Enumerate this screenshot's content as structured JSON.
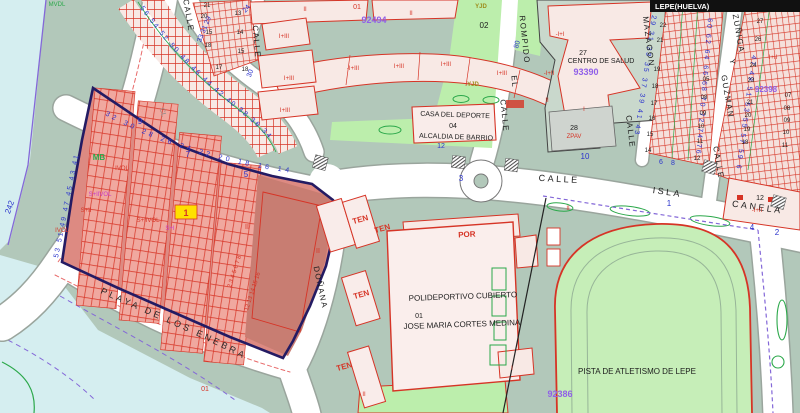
{
  "title": "LEPE(HUELVA)",
  "colors": {
    "c-sage": "#b2c8ba",
    "c-park": "#bceeac",
    "c-cyan": "#d5eef0",
    "c-street": "#ffffff",
    "c-casing": "#9aa59d",
    "c-pink": "#f8e9e5",
    "c-red": "#d63426",
    "c-blue": "#2a33cc",
    "c-purple": "#9060e8",
    "c-magenta": "#c83cc8",
    "c-greenline": "#2ba84a",
    "c-olive": "#9c8c1a",
    "c-zonebase": "#dd8a82",
    "c-zonestrip": "#f0a89f",
    "c-zonedark": "#c87d72",
    "c-zoneborder": "#241b63",
    "c-boundary": "#8468d8",
    "c-yellow": "#ffe000",
    "c-titlebar": "#111111"
  },
  "curved": {
    "chain_a": "56 54 52 50 48 46 44 42 40 38 36 34",
    "chain_b": "32 30 28 26 24 22 20 18 16 14",
    "left_edge": "53 51 49 47 45 43 41",
    "mazagon_w": "29 31 33 35 37 39 41 43",
    "guzman_w": "60 62 64 66 68 70 72 74 76",
    "guzman_e": "47 49 51 53 55 57 59 61",
    "playa": "PLAYA  DE  LOS  ENEBRALES"
  },
  "map": {
    "labels": [
      {
        "t": "MVDL",
        "x": 57,
        "y": 6,
        "r": 0,
        "c": "s6 c-green"
      },
      {
        "t": "CALLE",
        "x": 186,
        "y": 16,
        "r": 80,
        "c": "s8 c-black ls1"
      },
      {
        "t": "33 31 29",
        "x": 206,
        "y": 30,
        "r": -68,
        "c": "s7 c-blue"
      },
      {
        "t": "24",
        "x": 248,
        "y": 10,
        "r": -50,
        "c": "s7 c-blue"
      },
      {
        "t": "CALLE",
        "x": 254,
        "y": 42,
        "r": 85,
        "c": "s8 c-black ls1"
      },
      {
        "t": "30",
        "x": 252,
        "y": 74,
        "r": -70,
        "c": "s7 c-blue"
      },
      {
        "t": "21",
        "x": 207,
        "y": 7,
        "r": 0,
        "c": "s6 c-black"
      },
      {
        "t": "20",
        "x": 204,
        "y": 18,
        "r": 0,
        "c": "s6 c-black"
      },
      {
        "t": "13",
        "x": 238,
        "y": 15,
        "r": 0,
        "c": "s6 c-black"
      },
      {
        "t": "15",
        "x": 209,
        "y": 34,
        "r": 0,
        "c": "s6 c-black"
      },
      {
        "t": "14",
        "x": 240,
        "y": 34,
        "r": 0,
        "c": "s6 c-black"
      },
      {
        "t": "18",
        "x": 208,
        "y": 47,
        "r": 0,
        "c": "s6 c-black"
      },
      {
        "t": "15",
        "x": 241,
        "y": 53,
        "r": 0,
        "c": "s6 c-black"
      },
      {
        "t": "17",
        "x": 219,
        "y": 69,
        "r": 0,
        "c": "s6 c-black"
      },
      {
        "t": "18",
        "x": 245,
        "y": 71,
        "r": 0,
        "c": "s6 c-black"
      },
      {
        "t": "CL",
        "x": 161,
        "y": 113,
        "r": 75,
        "c": "s7 c-gray"
      },
      {
        "t": "MB",
        "x": 99,
        "y": 160,
        "r": 0,
        "c": "s8 c-green bold"
      },
      {
        "t": "242",
        "x": 12,
        "y": 208,
        "r": -70,
        "c": "s8 c-blue"
      },
      {
        "t": "9",
        "x": 140,
        "y": 124,
        "r": 0,
        "c": "s8 c-blue"
      },
      {
        "t": "7",
        "x": 188,
        "y": 157,
        "r": 0,
        "c": "s8 c-blue"
      },
      {
        "t": "5",
        "x": 246,
        "y": 177,
        "r": 0,
        "c": "s8 c-blue"
      },
      {
        "t": "IVOL",
        "x": 122,
        "y": 170,
        "r": 0,
        "c": "s6 c-red"
      },
      {
        "t": "S+IIVOL",
        "x": 100,
        "y": 196,
        "r": 0,
        "c": "s6 c-mag"
      },
      {
        "t": "S+II",
        "x": 86,
        "y": 212,
        "r": 0,
        "c": "s6 c-red"
      },
      {
        "t": "IVOL",
        "x": 62,
        "y": 232,
        "r": 0,
        "c": "s6 c-red"
      },
      {
        "t": "S+IIVOL",
        "x": 148,
        "y": 222,
        "r": 0,
        "c": "s6 c-red"
      },
      {
        "t": "S+I",
        "x": 170,
        "y": 230,
        "r": 0,
        "c": "s6 c-mag"
      },
      {
        "t": "II",
        "x": 247,
        "y": 229,
        "r": 0,
        "c": "s7 c-red"
      },
      {
        "t": "II",
        "x": 318,
        "y": 253,
        "r": 0,
        "c": "s7 c-red"
      },
      {
        "t": "1",
        "x": 186,
        "y": 216,
        "r": 0,
        "c": "s9 c-red bold"
      },
      {
        "t": "01",
        "x": 205,
        "y": 391,
        "r": 0,
        "c": "s7 c-red"
      },
      {
        "t": "2 3 4 5 6 7 8",
        "x": 236,
        "y": 272,
        "r": -72,
        "c": "s6 c-red"
      },
      {
        "t": "12 13 14 15 16",
        "x": 254,
        "y": 292,
        "r": -72,
        "c": "s6 c-red"
      },
      {
        "t": "DOÑANA",
        "x": 318,
        "y": 288,
        "r": 78,
        "c": "s8 c-black ls1"
      },
      {
        "t": "01",
        "x": 357,
        "y": 9,
        "r": 0,
        "c": "s7 c-red"
      },
      {
        "t": "II",
        "x": 305,
        "y": 11,
        "r": 0,
        "c": "s6 c-red"
      },
      {
        "t": "II",
        "x": 411,
        "y": 15,
        "r": 0,
        "c": "s6 c-red"
      },
      {
        "t": "92494",
        "x": 374,
        "y": 23,
        "r": 0,
        "c": "s9 c-purple"
      },
      {
        "t": "I+III",
        "x": 284,
        "y": 38,
        "r": 0,
        "c": "s6 c-red"
      },
      {
        "t": "I+III",
        "x": 289,
        "y": 80,
        "r": 0,
        "c": "s6 c-red"
      },
      {
        "t": "I+III",
        "x": 285,
        "y": 112,
        "r": 0,
        "c": "s6 c-red"
      },
      {
        "t": "-I+III",
        "x": 353,
        "y": 70,
        "r": 0,
        "c": "s6 c-red"
      },
      {
        "t": "I+III",
        "x": 399,
        "y": 68,
        "r": 0,
        "c": "s6 c-red"
      },
      {
        "t": "I+III",
        "x": 446,
        "y": 66,
        "r": 0,
        "c": "s6 c-red"
      },
      {
        "t": "I+III",
        "x": 502,
        "y": 75,
        "r": 0,
        "c": "s6 c-red"
      },
      {
        "t": "YJD",
        "x": 481,
        "y": 8,
        "r": 0,
        "c": "s6 c-olive"
      },
      {
        "t": "02",
        "x": 484,
        "y": 28,
        "r": 0,
        "c": "s8 c-black"
      },
      {
        "t": "YJD",
        "x": 473,
        "y": 86,
        "r": 0,
        "c": "s6 c-olive"
      },
      {
        "t": "80",
        "x": 519,
        "y": 45,
        "r": -75,
        "c": "s7 c-blue"
      },
      {
        "t": "CALLE",
        "x": 502,
        "y": 116,
        "r": 84,
        "c": "s8 c-black ls1"
      },
      {
        "t": "EL",
        "x": 512,
        "y": 82,
        "r": 84,
        "c": "s8 c-black ls1"
      },
      {
        "t": "ROMPIDO",
        "x": 522,
        "y": 40,
        "r": 84,
        "c": "s8 c-black ls1"
      },
      {
        "t": "CASA DEL DEPORTE",
        "x": 455,
        "y": 117,
        "r": 2,
        "c": "s7 c-black"
      },
      {
        "t": "04",
        "x": 453,
        "y": 128,
        "r": 0,
        "c": "s7 c-black"
      },
      {
        "t": "ALCALDIA DE BARRIO",
        "x": 456,
        "y": 139,
        "r": 2,
        "c": "s7 c-black"
      },
      {
        "t": "12",
        "x": 441,
        "y": 148,
        "r": 0,
        "c": "s7 c-blue"
      },
      {
        "t": "CALLE",
        "x": 559,
        "y": 182,
        "r": 3,
        "c": "s9 c-black ls2"
      },
      {
        "t": "3",
        "x": 461,
        "y": 181,
        "r": 0,
        "c": "s8 c-blue"
      },
      {
        "t": "10",
        "x": 585,
        "y": 159,
        "r": 0,
        "c": "s8 c-blue"
      },
      {
        "t": "ISLA",
        "x": 667,
        "y": 195,
        "r": 8,
        "c": "s9 c-black ls2"
      },
      {
        "t": "1",
        "x": 669,
        "y": 206,
        "r": 0,
        "c": "s8 c-blue"
      },
      {
        "t": "CANELA",
        "x": 757,
        "y": 210,
        "r": 8,
        "c": "s9 c-black ls2"
      },
      {
        "t": "-I+I",
        "x": 560,
        "y": 36,
        "r": 0,
        "c": "s6 c-red"
      },
      {
        "t": "27",
        "x": 583,
        "y": 55,
        "r": 0,
        "c": "s7 c-black"
      },
      {
        "t": "CENTRO DE SALUD",
        "x": 601,
        "y": 63,
        "r": 0,
        "c": "s7 c-black"
      },
      {
        "t": "93390",
        "x": 586,
        "y": 75,
        "r": 0,
        "c": "s9 c-purple"
      },
      {
        "t": "-I+II",
        "x": 549,
        "y": 75,
        "r": 0,
        "c": "s6 c-red"
      },
      {
        "t": "II",
        "x": 547,
        "y": 102,
        "r": 0,
        "c": "s6 c-red"
      },
      {
        "t": "I",
        "x": 584,
        "y": 111,
        "r": 0,
        "c": "s6 c-red"
      },
      {
        "t": "28",
        "x": 574,
        "y": 130,
        "r": 0,
        "c": "s7 c-black"
      },
      {
        "t": "ZPAV",
        "x": 574,
        "y": 138,
        "r": 0,
        "c": "s6 c-red"
      },
      {
        "t": "MAZAGON",
        "x": 646,
        "y": 42,
        "r": 83,
        "c": "s8 c-black ls1"
      },
      {
        "t": "CALLE",
        "x": 628,
        "y": 132,
        "r": 83,
        "c": "s8 c-black ls1"
      },
      {
        "t": "ZUÑIGA",
        "x": 736,
        "y": 34,
        "r": 80,
        "c": "s8 c-black ls1"
      },
      {
        "t": "Y",
        "x": 730,
        "y": 62,
        "r": 80,
        "c": "s8 c-black"
      },
      {
        "t": "GUZMAN",
        "x": 725,
        "y": 97,
        "r": 80,
        "c": "s8 c-black ls1"
      },
      {
        "t": "CALLE",
        "x": 716,
        "y": 163,
        "r": 80,
        "c": "s8 c-black ls1"
      },
      {
        "t": "23",
        "x": 665,
        "y": 11,
        "r": 0,
        "c": "s6 c-black"
      },
      {
        "t": "22",
        "x": 663,
        "y": 27,
        "r": 0,
        "c": "s6 c-black"
      },
      {
        "t": "21",
        "x": 660,
        "y": 42,
        "r": 0,
        "c": "s6 c-black"
      },
      {
        "t": "19",
        "x": 657,
        "y": 71,
        "r": 0,
        "c": "s6 c-black"
      },
      {
        "t": "18",
        "x": 655,
        "y": 88,
        "r": 0,
        "c": "s6 c-black"
      },
      {
        "t": "17",
        "x": 654,
        "y": 105,
        "r": 0,
        "c": "s6 c-black"
      },
      {
        "t": "16",
        "x": 652,
        "y": 120,
        "r": 0,
        "c": "s6 c-black"
      },
      {
        "t": "15",
        "x": 650,
        "y": 136,
        "r": 0,
        "c": "s6 c-black"
      },
      {
        "t": "14",
        "x": 648,
        "y": 152,
        "r": 0,
        "c": "s6 c-black"
      },
      {
        "t": "05",
        "x": 706,
        "y": 81,
        "r": 0,
        "c": "s6 c-black"
      },
      {
        "t": "08",
        "x": 704,
        "y": 99,
        "r": 0,
        "c": "s6 c-black"
      },
      {
        "t": "09",
        "x": 703,
        "y": 115,
        "r": 0,
        "c": "s6 c-black"
      },
      {
        "t": "10",
        "x": 701,
        "y": 128,
        "r": 0,
        "c": "s6 c-black"
      },
      {
        "t": "11",
        "x": 700,
        "y": 143,
        "r": 0,
        "c": "s6 c-black"
      },
      {
        "t": "12",
        "x": 697,
        "y": 160,
        "r": 0,
        "c": "s6 c-black"
      },
      {
        "t": "27",
        "x": 760,
        "y": 23,
        "r": 0,
        "c": "s6 c-black"
      },
      {
        "t": "26",
        "x": 758,
        "y": 41,
        "r": 0,
        "c": "s6 c-black"
      },
      {
        "t": "24",
        "x": 753,
        "y": 67,
        "r": 0,
        "c": "s6 c-black"
      },
      {
        "t": "23",
        "x": 751,
        "y": 82,
        "r": 0,
        "c": "s6 c-black"
      },
      {
        "t": "21",
        "x": 750,
        "y": 104,
        "r": 0,
        "c": "s6 c-black"
      },
      {
        "t": "20",
        "x": 748,
        "y": 117,
        "r": 0,
        "c": "s6 c-black"
      },
      {
        "t": "19",
        "x": 747,
        "y": 131,
        "r": 0,
        "c": "s6 c-black"
      },
      {
        "t": "18",
        "x": 745,
        "y": 144,
        "r": 0,
        "c": "s6 c-black"
      },
      {
        "t": "92398",
        "x": 766,
        "y": 92,
        "r": 0,
        "c": "s8 c-purple"
      },
      {
        "t": "-I+II",
        "x": 772,
        "y": 59,
        "r": 0,
        "c": "s6 c-red"
      },
      {
        "t": "07",
        "x": 788,
        "y": 97,
        "r": 0,
        "c": "s6 c-black"
      },
      {
        "t": "08",
        "x": 787,
        "y": 110,
        "r": 0,
        "c": "s6 c-black"
      },
      {
        "t": "09",
        "x": 787,
        "y": 122,
        "r": 0,
        "c": "s6 c-black"
      },
      {
        "t": "10",
        "x": 786,
        "y": 134,
        "r": 0,
        "c": "s6 c-black"
      },
      {
        "t": "11",
        "x": 785,
        "y": 147,
        "r": 0,
        "c": "s6 c-black"
      },
      {
        "t": "6",
        "x": 661,
        "y": 164,
        "r": 0,
        "c": "s7 c-blue"
      },
      {
        "t": "8",
        "x": 673,
        "y": 165,
        "r": 0,
        "c": "s7 c-blue"
      },
      {
        "t": "12",
        "x": 760,
        "y": 200,
        "r": 0,
        "c": "s7 c-black"
      },
      {
        "t": "-I+II",
        "x": 757,
        "y": 212,
        "r": 0,
        "c": "s6 c-red"
      },
      {
        "t": "4",
        "x": 752,
        "y": 230,
        "r": 0,
        "c": "s8 c-blue"
      },
      {
        "t": "2",
        "x": 777,
        "y": 235,
        "r": 0,
        "c": "s8 c-blue"
      },
      {
        "t": "TEN",
        "x": 361,
        "y": 222,
        "r": -15,
        "c": "s8 c-red bold"
      },
      {
        "t": "TEN",
        "x": 383,
        "y": 231,
        "r": -15,
        "c": "s8 c-red bold"
      },
      {
        "t": "TEN",
        "x": 362,
        "y": 297,
        "r": -15,
        "c": "s8 c-red bold"
      },
      {
        "t": "TEN",
        "x": 345,
        "y": 369,
        "r": -15,
        "c": "s8 c-red bold"
      },
      {
        "t": "POR",
        "x": 467,
        "y": 237,
        "r": -3,
        "c": "s8 c-red bold"
      },
      {
        "t": "POLIDEPORTIVO CUBIERTO",
        "x": 463,
        "y": 299,
        "r": -2,
        "c": "s8 c-black"
      },
      {
        "t": "01",
        "x": 419,
        "y": 318,
        "r": 0,
        "c": "s7 c-black"
      },
      {
        "t": "JOSE MARIA CORTES MEDINA",
        "x": 462,
        "y": 327,
        "r": -2,
        "c": "s8 c-black"
      },
      {
        "t": "II",
        "x": 568,
        "y": 210,
        "r": 0,
        "c": "s6 c-red"
      },
      {
        "t": "I",
        "x": 512,
        "y": 370,
        "r": 0,
        "c": "s6 c-red"
      },
      {
        "t": "II",
        "x": 364,
        "y": 396,
        "r": 0,
        "c": "s6 c-red"
      },
      {
        "t": "PISTA DE ATLETISMO DE LEPE",
        "x": 637,
        "y": 374,
        "r": 0,
        "c": "s8 c-black"
      },
      {
        "t": "92386",
        "x": 560,
        "y": 397,
        "r": 0,
        "c": "s9 c-purple"
      }
    ]
  }
}
